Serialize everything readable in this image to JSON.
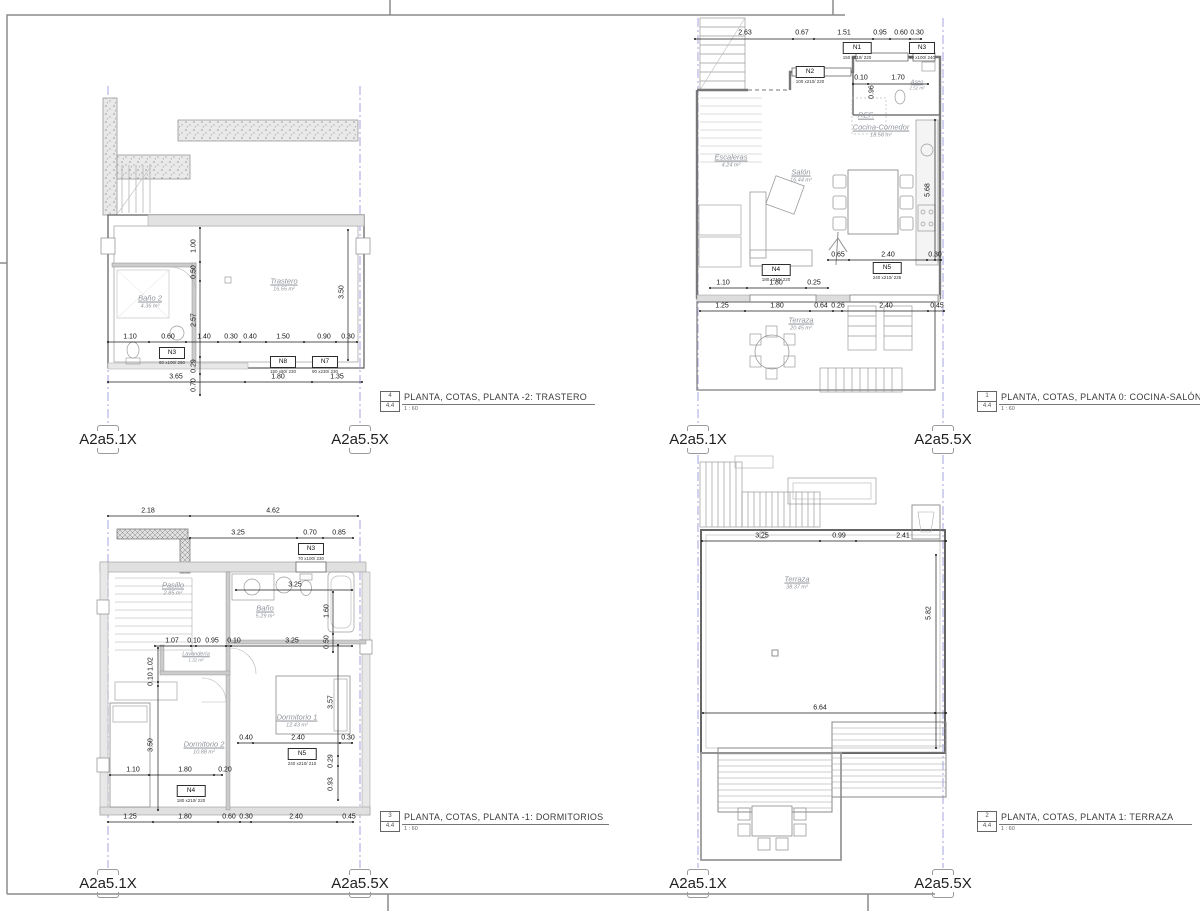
{
  "sheet": {
    "marker_left": "A2a5.1X",
    "marker_right": "A2a5.5X"
  },
  "titles": {
    "trastero": {
      "num": "4",
      "sheet": "4.4",
      "text": "PLANTA, COTAS, PLANTA -2: TRASTERO",
      "scale": "1 : 60"
    },
    "cocina": {
      "num": "1",
      "sheet": "4.4",
      "text": "PLANTA, COTAS, PLANTA 0: COCINA-SALÓN",
      "scale": "1 : 60"
    },
    "dormitorios": {
      "num": "3",
      "sheet": "4.4",
      "text": "PLANTA, COTAS, PLANTA -1: DORMITORIOS",
      "scale": "1 : 60"
    },
    "terraza": {
      "num": "2",
      "sheet": "4.4",
      "text": "PLANTA, COTAS, PLANTA 1: TERRAZA",
      "scale": "1 : 60"
    }
  },
  "plans": {
    "trastero": {
      "rooms": {
        "trastero": {
          "name": "Trastero",
          "area": "16.55 m²"
        },
        "bano2": {
          "name": "Baño 2",
          "area": "4.36 m²"
        }
      },
      "tags": {
        "n3": {
          "id": "N3",
          "size": "60 x100/ 250"
        },
        "n8": {
          "id": "N8",
          "size": "150 x80/ 230"
        },
        "n7": {
          "id": "N7",
          "size": "90 x230/ 230"
        }
      },
      "dims": {
        "row1": [
          "1.10",
          "0.60",
          "1.40",
          "0.30",
          "0.40",
          "1.50",
          "0.90",
          "0.30"
        ],
        "row2": [
          "3.65",
          "1.80",
          "1.35"
        ],
        "vert": [
          "1.00",
          "0.50",
          "2.57",
          "0.29",
          "0.70"
        ],
        "right": [
          "3.50"
        ]
      }
    },
    "cocina": {
      "rooms": {
        "escaleras": {
          "name": "Escaleras",
          "area": "4.24 m²"
        },
        "salon": {
          "name": "Salón",
          "area": "16.44 m²"
        },
        "ref": {
          "name": "REF."
        },
        "cocina": {
          "name": "Cocina-Comedor",
          "area": "18.56 m²"
        },
        "aseo": {
          "name": "Aseo",
          "area": "2.52 m²"
        },
        "terraza": {
          "name": "Terraza",
          "area": "20.45 m²"
        }
      },
      "tags": {
        "n1": {
          "id": "N1",
          "size": "150 x210/ 220"
        },
        "n3": {
          "id": "N3",
          "size": "60 x100/ 240"
        },
        "n2": {
          "id": "N2",
          "size": "100 x210/ 220"
        },
        "n4": {
          "id": "N4",
          "size": "180 x210/ 220"
        },
        "n5": {
          "id": "N5",
          "size": "240 x210/ 225"
        }
      },
      "dims": {
        "top": [
          "2.63",
          "0.67",
          "1.51",
          "0.95",
          "0.60",
          "0.30"
        ],
        "aseo": [
          "0.10",
          "0.96",
          "1.70"
        ],
        "sofa": [
          "0.65",
          "2.40",
          "0.30"
        ],
        "n4row": [
          "1.10",
          "1.80",
          "0.25"
        ],
        "bottom": [
          "1.25",
          "1.80",
          "0.64",
          "0.26",
          "2.40",
          "0.45"
        ],
        "right": [
          "5.68"
        ]
      }
    },
    "dormitorios": {
      "rooms": {
        "pasillo": {
          "name": "Pasillo",
          "area": "2.85 m²"
        },
        "bano": {
          "name": "Baño",
          "area": "5.29 m²"
        },
        "lavanderia": {
          "name": "Lavandería",
          "area": "1.32 m²"
        },
        "dorm1": {
          "name": "Dormitorio 1",
          "area": "12.43 m²"
        },
        "dorm2": {
          "name": "Dormitorio 2",
          "area": "10.88 m²"
        }
      },
      "tags": {
        "n3": {
          "id": "N3",
          "size": "70 x100/ 230"
        },
        "n5": {
          "id": "N5",
          "size": "240 x210/ 210"
        },
        "n4": {
          "id": "N4",
          "size": "180 x210/ 220"
        }
      },
      "dims": {
        "top1": [
          "2.18",
          "4.62"
        ],
        "top2": [
          "3.25",
          "0.70",
          "0.85"
        ],
        "bano": [
          "3.25",
          "1.60",
          "0.50"
        ],
        "lav": [
          "1.07",
          "0.10",
          "0.95",
          "0.10",
          "3.25"
        ],
        "vleft": [
          "1.02",
          "0.10",
          "3.50"
        ],
        "vright": [
          "3.57",
          "0.29",
          "0.93"
        ],
        "n5row": [
          "0.40",
          "2.40",
          "0.30"
        ],
        "n4row": [
          "1.10",
          "1.80",
          "0.20"
        ],
        "bottom": [
          "1.25",
          "1.80",
          "0.60",
          "0.30",
          "2.40",
          "0.45"
        ]
      }
    },
    "terraza": {
      "rooms": {
        "terraza": {
          "name": "Terraza",
          "area": "38.37 m²"
        }
      },
      "dims": {
        "top": [
          "3.25",
          "0.99",
          "2.41"
        ],
        "right": [
          "5.82"
        ],
        "bottom": [
          "6.64"
        ]
      }
    }
  }
}
